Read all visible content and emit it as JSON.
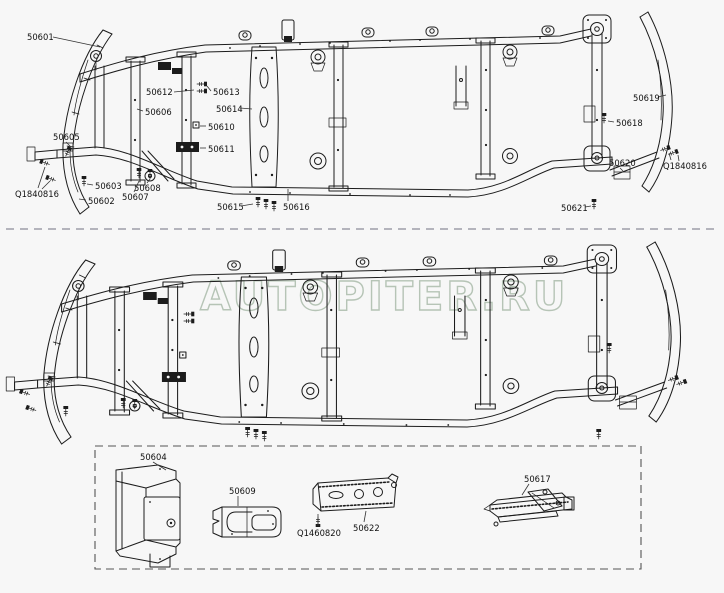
{
  "watermark": {
    "text": "AUTOPITER.RU",
    "color": "#b3c2b3"
  },
  "colors": {
    "background": "#f7f7f7",
    "line": "#1c1c1c",
    "divider": "#8d8d98",
    "parts_box": "#555555",
    "label": "#111111"
  },
  "diagram": {
    "description_parts_labeled": [
      "50601",
      "50612",
      "50613",
      "50606",
      "50614",
      "50610",
      "50611",
      "50605",
      "Q1840816",
      "50603",
      "50602",
      "50608",
      "50607",
      "50615",
      "50616",
      "50619",
      "50618",
      "50620",
      "50621",
      "50604",
      "50609",
      "Q1460820",
      "50622",
      "50617"
    ]
  },
  "callouts": [
    {
      "label": "50601",
      "tx": 27,
      "ty": 40,
      "leaders": [
        [
          53,
          37,
          100,
          47
        ]
      ]
    },
    {
      "label": "50612",
      "tx": 146,
      "ty": 95,
      "leaders": [
        [
          174,
          92,
          194,
          90
        ]
      ]
    },
    {
      "label": "50613",
      "tx": 213,
      "ty": 95,
      "leaders": [
        [
          211,
          91,
          207,
          86
        ]
      ]
    },
    {
      "label": "50606",
      "tx": 145,
      "ty": 115,
      "leaders": [
        [
          143,
          111,
          137,
          109
        ]
      ]
    },
    {
      "label": "50614",
      "tx": 216,
      "ty": 112,
      "leaders": [
        [
          240,
          108,
          252,
          109
        ]
      ]
    },
    {
      "label": "50610",
      "tx": 208,
      "ty": 130,
      "leaders": [
        [
          206,
          126,
          200,
          126
        ]
      ]
    },
    {
      "label": "50611",
      "tx": 208,
      "ty": 152,
      "leaders": [
        [
          206,
          148,
          200,
          148
        ]
      ]
    },
    {
      "label": "50605",
      "tx": 53,
      "ty": 140,
      "leaders": [
        [
          66,
          142,
          71,
          147
        ]
      ]
    },
    {
      "label": "Q1840816",
      "tx": 15,
      "ty": 197,
      "leaders": [
        [
          38,
          188,
          45,
          167
        ],
        [
          42,
          189,
          50,
          181
        ]
      ]
    },
    {
      "label": "50603",
      "tx": 95,
      "ty": 189,
      "leaders": [
        [
          93,
          185,
          87,
          184
        ]
      ]
    },
    {
      "label": "50602",
      "tx": 88,
      "ty": 204,
      "leaders": [
        [
          86,
          200,
          79,
          199
        ]
      ]
    },
    {
      "label": "50608",
      "tx": 134,
      "ty": 191,
      "leaders": [
        [
          147,
          183,
          150,
          179
        ]
      ]
    },
    {
      "label": "50607",
      "tx": 122,
      "ty": 200,
      "leaders": [
        [
          134,
          192,
          139,
          181
        ]
      ]
    },
    {
      "label": "50615",
      "tx": 217,
      "ty": 210,
      "leaders": [
        [
          241,
          206,
          253,
          204
        ]
      ]
    },
    {
      "label": "50616",
      "tx": 283,
      "ty": 210,
      "leaders": [
        [
          288,
          201,
          288,
          189
        ]
      ]
    },
    {
      "label": "50619",
      "tx": 633,
      "ty": 101,
      "leaders": [
        [
          658,
          97,
          666,
          95
        ]
      ]
    },
    {
      "label": "50618",
      "tx": 616,
      "ty": 126,
      "leaders": [
        [
          614,
          122,
          608,
          121
        ]
      ]
    },
    {
      "label": "50620",
      "tx": 609,
      "ty": 166,
      "leaders": [
        [
          620,
          168,
          623,
          171
        ]
      ]
    },
    {
      "label": "Q1840816",
      "tx": 663,
      "ty": 169,
      "leaders": [
        [
          671,
          160,
          669,
          153
        ],
        [
          679,
          161,
          678,
          155
        ]
      ]
    },
    {
      "label": "50621",
      "tx": 561,
      "ty": 211,
      "leaders": [
        [
          585,
          207,
          591,
          206
        ]
      ]
    },
    {
      "label": "50604",
      "tx": 140,
      "ty": 460,
      "leaders": [
        [
          153,
          462,
          166,
          470
        ]
      ]
    },
    {
      "label": "50609",
      "tx": 229,
      "ty": 494,
      "leaders": [
        [
          238,
          496,
          238,
          506
        ]
      ]
    },
    {
      "label": "Q1460820",
      "tx": 297,
      "ty": 536,
      "leaders": [
        [
          318,
          526,
          318,
          514
        ]
      ]
    },
    {
      "label": "50622",
      "tx": 353,
      "ty": 531,
      "leaders": [
        [
          364,
          522,
          366,
          511
        ]
      ]
    },
    {
      "label": "50617",
      "tx": 524,
      "ty": 482,
      "leaders": [
        [
          529,
          484,
          522,
          495
        ]
      ]
    }
  ]
}
